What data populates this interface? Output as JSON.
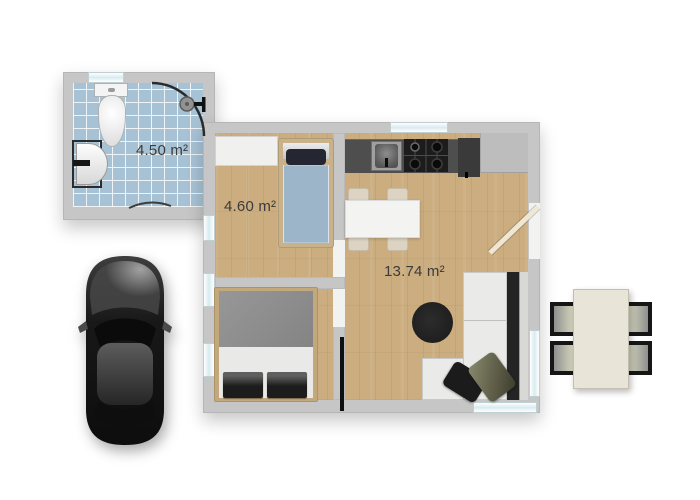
{
  "plan_title": "apartment-floor-plan",
  "rooms": [
    {
      "name": "bathroom",
      "area_label": "4.50 m²"
    },
    {
      "name": "small-bedroom",
      "area_label": "4.60 m²"
    },
    {
      "name": "living-kitchen",
      "area_label": "13.74 m²"
    }
  ],
  "colors": {
    "page-bg": "#ffffff",
    "wall": "#c6c6c6",
    "wood": "#cbad7f",
    "tile": "#a8c2d5",
    "glass": "#d6ecf1",
    "counter-dark": "#4e4e4e",
    "counter-light": "#bdbdbd",
    "fridge": "#3a3a3a",
    "sofa-seat": "#eaeae8",
    "sofa-dark": "#242424",
    "rug": "#1e1e1e",
    "bed-blue": "#9cb5c9",
    "blanket-gray": "#8d8d8d",
    "sheet-white": "#e9e9e7",
    "table-white": "#f3f3f1",
    "chair-beige": "#dcd3c3",
    "patio-table": "#e8e5d8",
    "bed-frame": "#c9b189",
    "wardrobe": "#f0f0ee",
    "label-text": "#3b3b3b",
    "car-body": "#161616"
  }
}
